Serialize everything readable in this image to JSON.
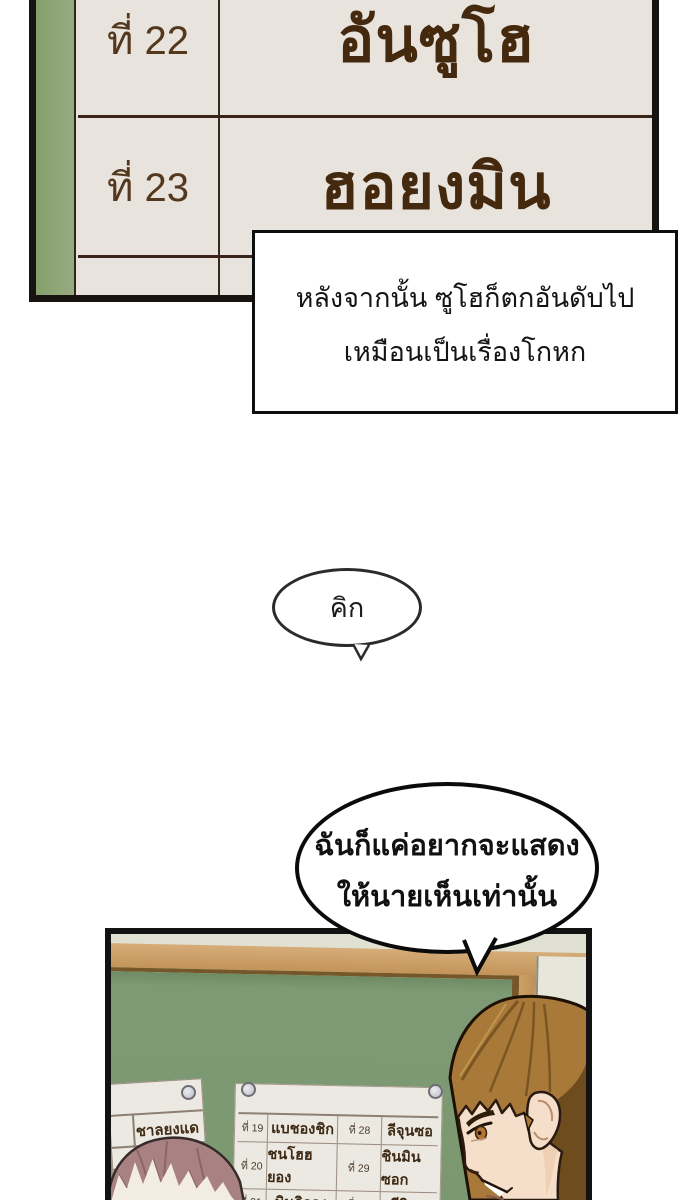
{
  "ranking_panel": {
    "rows": [
      {
        "rank": "ที่ 22",
        "name": "อันซูโฮ"
      },
      {
        "rank": "ที่ 23",
        "name": "ฮอยงมิน"
      },
      {
        "rank": "",
        "name": ""
      }
    ],
    "colors": {
      "paper": "#e9e3de",
      "green_strip": "#8ca476",
      "border": "#171310",
      "text": "#45290f"
    }
  },
  "narration": {
    "line1": "หลังจากนั้น ซูโฮก็ตกอันดับไป",
    "line2": "เหมือนเป็นเรื่องโกหก"
  },
  "sfx_bubble": {
    "text": "คิก"
  },
  "speech_bubble": {
    "line1": "ฉันก็แค่อยากจะแสดง",
    "line2": "ให้นายเห็นเท่านั้น"
  },
  "classroom_panel": {
    "left_paper": {
      "name": "ชาลยงแด"
    },
    "board_paper": {
      "rows": [
        {
          "rank_left": "ที่ 19",
          "name_left": "แบชองชิก",
          "rank_right": "ที่ 28",
          "name_right": "ลีจุนซอ"
        },
        {
          "rank_left": "ที่ 20",
          "name_left": "ชนโฮฮยอง",
          "rank_right": "ที่ 29",
          "name_right": "ชินมินซอก"
        },
        {
          "rank_left": "ที่ 21",
          "name_left": "มินกิลจุง",
          "rank_right": "ที่ 30",
          "name_right": "ลีจินอู"
        },
        {
          "rank_left": "",
          "name_left": "",
          "rank_right": "",
          "name_right": ""
        }
      ]
    },
    "colors": {
      "chalkboard": "#7b9871",
      "wood_frame": "#c2945a",
      "wall": "#e6e7da"
    }
  }
}
